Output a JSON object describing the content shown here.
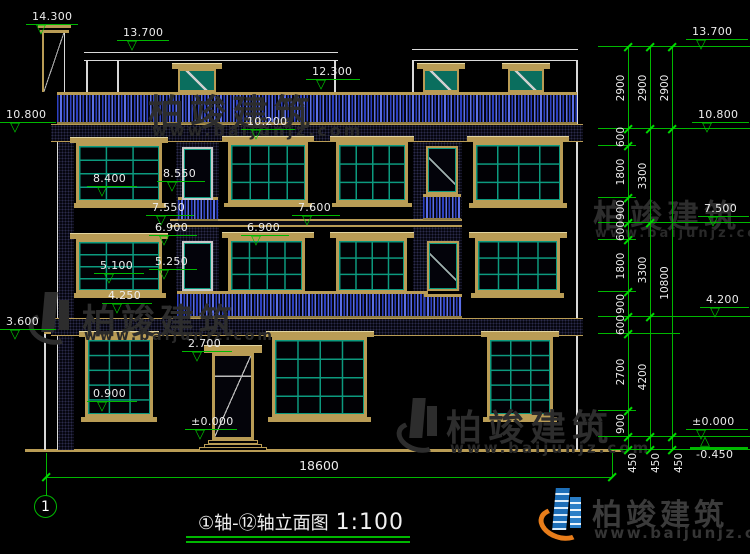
{
  "levels": {
    "v14300": "14.300",
    "v13700": "13.700",
    "v12300": "12.300",
    "v10800": "10.800",
    "v10200": "10.200",
    "v8550": "8.550",
    "v8400": "8.400",
    "v7600": "7.600",
    "v7550": "7.550",
    "v7500": "7.500",
    "v6900": "6.900",
    "v5250": "5.250",
    "v5100": "5.100",
    "v4250": "4.250",
    "v4200": "4.200",
    "v3600": "3.600",
    "v2700": "2.700",
    "v0900": "0.900",
    "v0000": "±0.000",
    "vm0450": "-0.450"
  },
  "dims": {
    "chain_inner": [
      "2900",
      "600",
      "1800",
      "900",
      "600",
      "1800",
      "900",
      "600",
      "2700",
      "900",
      "450"
    ],
    "chain_mid": [
      "2900",
      "3300",
      "3300",
      "4200",
      "450"
    ],
    "chain_outer": [
      "2900",
      "10800",
      "450"
    ],
    "total": "18600"
  },
  "footer": {
    "axis_bubble": "1",
    "title": "①轴-⑫轴立面图",
    "scale": "1:100"
  },
  "brand": {
    "name": "柏竣建筑",
    "url": "www.baijunjz.com"
  },
  "colors": {
    "background": "#000000",
    "outline": "#d9d9d9",
    "trim_tan": "#b99c55",
    "glass_teal": "#0c9a7f",
    "baluster_blue": "#3a4fd0",
    "dimension_green": "#00b800",
    "text": "#ececec",
    "watermark": "#2d2d2d",
    "logo_blue": "#1e6fb8",
    "logo_orange": "#e87d1a"
  }
}
